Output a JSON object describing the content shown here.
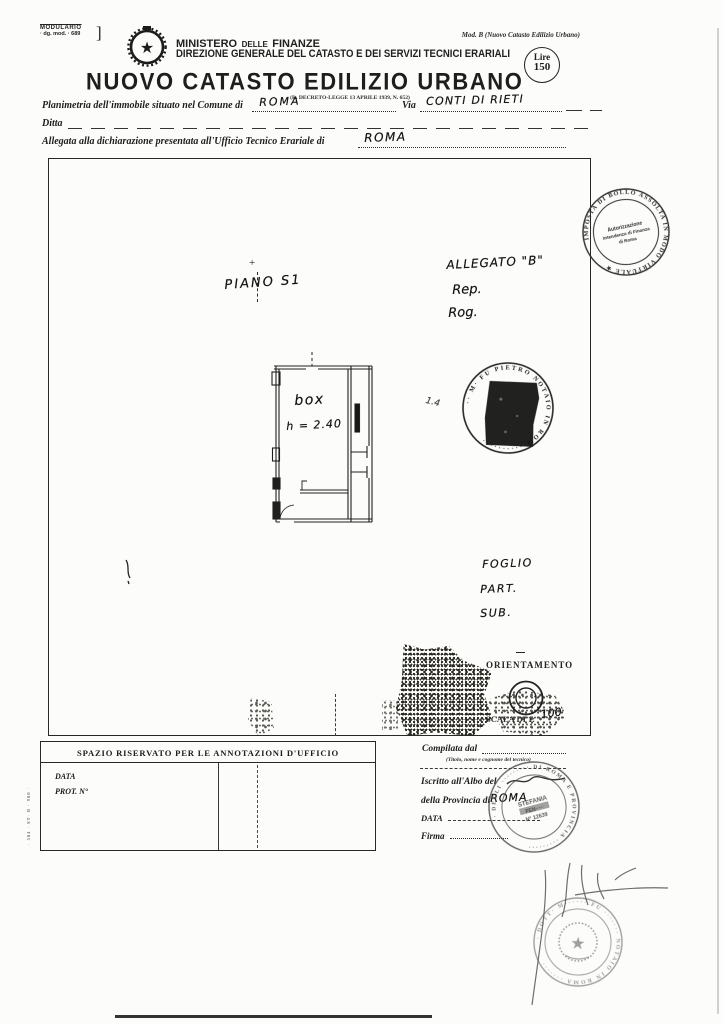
{
  "scan": {
    "modulario_1": "MODULARIO",
    "modulario_2": "· dg. mod. · 689",
    "bracket": "]",
    "mod_ref": "Mod. B (Nuovo Catasto Edilizio Urbano)",
    "edge_print": "· 584 · ST· B · 980 ·"
  },
  "header": {
    "ministry_1": "MINISTERO",
    "ministry_2": "DELLE",
    "ministry_3": "FINANZE",
    "direction": "DIREZIONE GENERALE DEL CATASTO E DEI SERVIZI TECNICI ERARIALI",
    "title": "NUOVO CATASTO EDILIZIO URBANO",
    "law_ref": "(R. DECRETO-LEGGE 13 APRILE 1939, N. 652)",
    "lire_label": "Lire",
    "lire_value": "150"
  },
  "form": {
    "line1_label": "Planimetria dell'immobile situato nel Comune di",
    "comune_value": "ROMA",
    "via_label": "Via",
    "via_value": "CONTI DI RIETI",
    "ditta_label": "Ditta",
    "line3_label": "Allegata alla dichiarazione presentata all'Ufficio Tecnico Erariale di",
    "ufficio_value": "ROMA"
  },
  "plan": {
    "piano_note": "PIANO S1",
    "allegato_note": "ALLEGATO \"B\"",
    "rep_note": "Rep.",
    "rog_note": "Rog.",
    "room_label": "box",
    "room_height_note": "h = 2.40",
    "pen_mark": "1.4",
    "foglio_note": "FOGLIO",
    "part_note": "PART.",
    "sub_note": "SUB.",
    "orientamento_label": "ORIENTAMENTO",
    "scala_label": "SCALA DI 1:",
    "scala_value": "100"
  },
  "stamps": {
    "bollo_rim": "IMPOSTA DI BOLLO ASSOLTA IN MODO VIRTUALE ★",
    "bollo_center_1": "Autorizzazione",
    "bollo_center_2": "Intendenza di Finanza",
    "bollo_center_3": "di Roma",
    "notary_rim": "·· M· FU PIETRO NOTAIO IN ROM ··········",
    "pro_rim": "· DEGLI ········· DI ROMA E PROVINCIA ·········",
    "pro_center_1": "STEFANIA",
    "pro_center_2": "PEN·····",
    "pro_center_3": "N° 12639",
    "bottom_rim": "· DOTT· M······ FU ······· NOTAIO IN ROMA ·······"
  },
  "annotations": {
    "title": "SPAZIO RISERVATO PER LE ANNOTAZIONI D'UFFICIO",
    "data_label": "DATA",
    "prot_label": "PROT. N°"
  },
  "compiled": {
    "compilata_label": "Compilata dal",
    "caption": "(Titolo, nome e cognome del tecnico)",
    "iscritto_label": "Iscritto all'Albo del",
    "provincia_label": "della Provincia di",
    "provincia_value": "ROMA",
    "data_label": "DATA",
    "firma_label": "Firma"
  }
}
